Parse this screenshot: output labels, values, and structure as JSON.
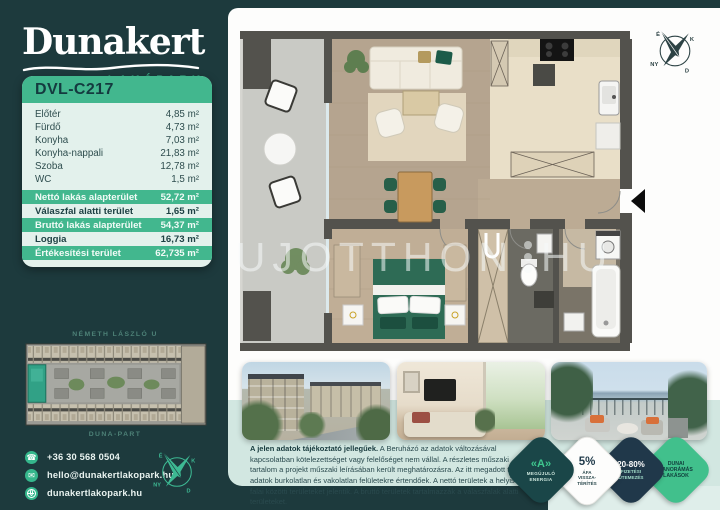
{
  "colors": {
    "background": "#1d3a3d",
    "accent_green": "#3fbf92",
    "header_green": "#42b78e",
    "card_mint": "#e3f1ec",
    "band_mint": "#d2e7e1",
    "badge_navy": "#20384a",
    "badge_teal": "#1a4648",
    "dark_text": "#16393c"
  },
  "brand": {
    "name": "Dunakert",
    "subtitle": "LAKÓPARK"
  },
  "unit": {
    "code": "DVL-C217"
  },
  "rooms": [
    {
      "label": "Előtér",
      "value": "4,85 m²"
    },
    {
      "label": "Fürdő",
      "value": "4,73 m²"
    },
    {
      "label": "Konyha",
      "value": "7,03 m²"
    },
    {
      "label": "Konyha-nappali",
      "value": "21,83 m²"
    },
    {
      "label": "Szoba",
      "value": "12,78 m²"
    },
    {
      "label": "WC",
      "value": "1,5 m²"
    }
  ],
  "summary": [
    {
      "label": "Nettó lakás alapterület",
      "value": "52,72 m²"
    },
    {
      "label": "Válaszfal alatti terület",
      "value": "1,65 m²"
    },
    {
      "label": "Bruttó lakás alapterület",
      "value": "54,37 m²"
    },
    {
      "label": "Loggia",
      "value": "16,73 m²"
    },
    {
      "label": "Értékesítési terület",
      "value": "62,735 m²"
    }
  ],
  "siteplan": {
    "top_label": "NÉMETH LÁSZLÓ U",
    "bottom_label": "DUNA-PART"
  },
  "contact": {
    "phone": "+36 30 568 0504",
    "email": "hello@dunakertlakopark.hu",
    "website": "dunakertlakopark.hu"
  },
  "compass": {
    "north": "É",
    "east": "K",
    "south": "D",
    "west": "NY"
  },
  "watermark": {
    "left": "UJOTTHON",
    "right": "HU"
  },
  "disclaimer": {
    "lead": "A jelen adatok tájékoztató jellegűek.",
    "body": "A Beruházó az adatok változásával kapcsolatban kötelezettséget vagy felelőséget nem vállal. A részletes műszaki tartalom a projekt műszaki leírásában került meghatározásra. Az itt megadott terület adatok burkolatlan és vakolatlan felületekre értendőek. A nettó területek a helyiségek falai közötti területeket jelentik. A bruttó területek tartalmazzák a válaszfalak alatti területeket."
  },
  "badges": [
    {
      "lines": [
        "«A»",
        "MEGÚJULÓ",
        "ENERGIA"
      ]
    },
    {
      "lines": [
        "5%",
        "ÁFA",
        "VISSZA-",
        "TÉRÍTÉS"
      ]
    },
    {
      "lines": [
        "20-80%",
        "FIZETÉSI",
        "ÜTEMEZÉS"
      ]
    },
    {
      "lines": [
        "DUNAI",
        "PANORÁMÁS",
        "LAKÁSOK"
      ]
    }
  ]
}
